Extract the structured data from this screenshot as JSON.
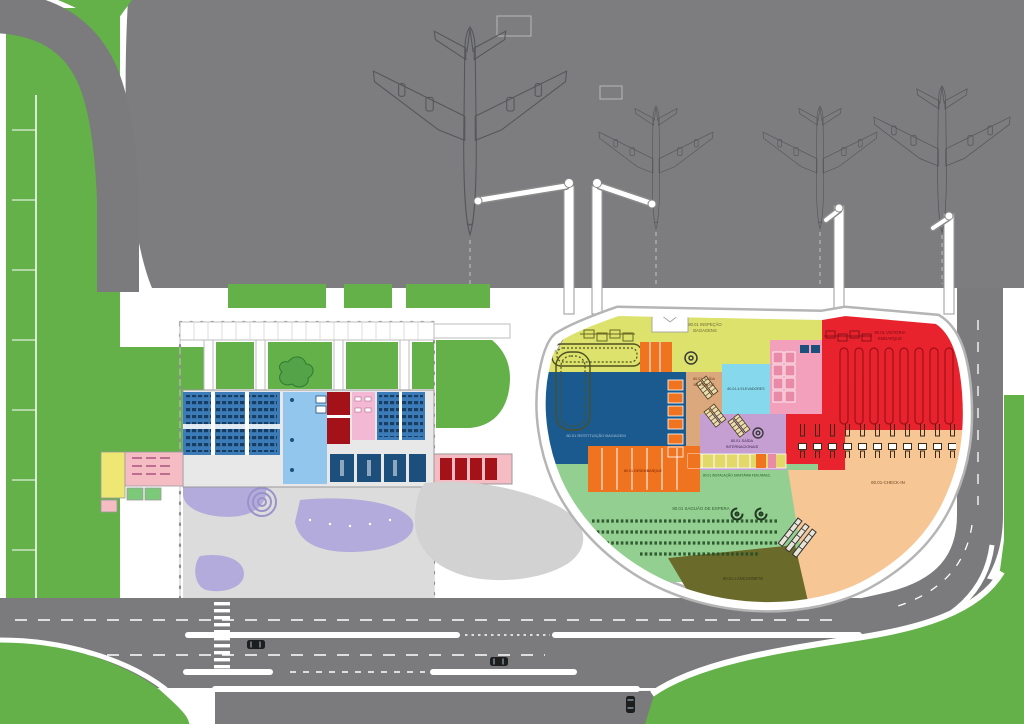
{
  "drawing": {
    "type": "airport-terminal-site-plan",
    "aircraft_count": "4"
  },
  "labels": {
    "inspecao_1": "80.01 INSPEÇÃO",
    "inspecao_2": "BAGAGENS",
    "vistoria_1": "80.01 VISTORIA",
    "vistoria_2": "EMBARQUE",
    "restituicao": "80.01 RESTITUIÇÃO BAGAGEM",
    "saida_nac_1": "80.01 SAÍDA",
    "saida_nac_2": "NACIONAIS",
    "elevadores": "80.01-4 ELEVADORES",
    "saida_int_1": "80.01-SAÍDA",
    "saida_int_2": "INTERNACIONAIS",
    "desembarque": "80.01 DESEMBARQUE",
    "sanitaria": "80.01 INSTALAÇÃO SANITÁRIA FEM./MASC.",
    "saguao": "80.01 SAGUÃO DE ESPERA",
    "checkin": "80.01-CHECK-IN",
    "lanchonete": "80.01 LANCHONETE"
  },
  "colors": {
    "green": "#63b148",
    "apron": "#7d7d7f",
    "road": "#7b7b7d",
    "zone_yellow": "#dce26b",
    "zone_red": "#e8232e",
    "zone_blue": "#1a5a8f",
    "zone_tan": "#dba77c",
    "zone_cyan": "#86d9ec",
    "zone_pink": "#f2a0bb",
    "zone_violet": "#c59ed2",
    "zone_orange": "#f0731f",
    "zone_green": "#94cf92",
    "zone_peach": "#f6c694",
    "zone_olive": "#6a6a2b",
    "bld_blue": "#3b7bb8",
    "bld_lightblue": "#92c6ec",
    "bld_darkred": "#a21218",
    "bld_pink": "#f3b8d4",
    "bld_navy": "#1c4f7c",
    "lavender": "#b3abdc",
    "plaza": "#dcdcdc",
    "annex_yellow": "#efe773",
    "annex_pink": "#f6bcc4",
    "annex_green": "#7cc979",
    "lake": "#d2d2d2"
  }
}
